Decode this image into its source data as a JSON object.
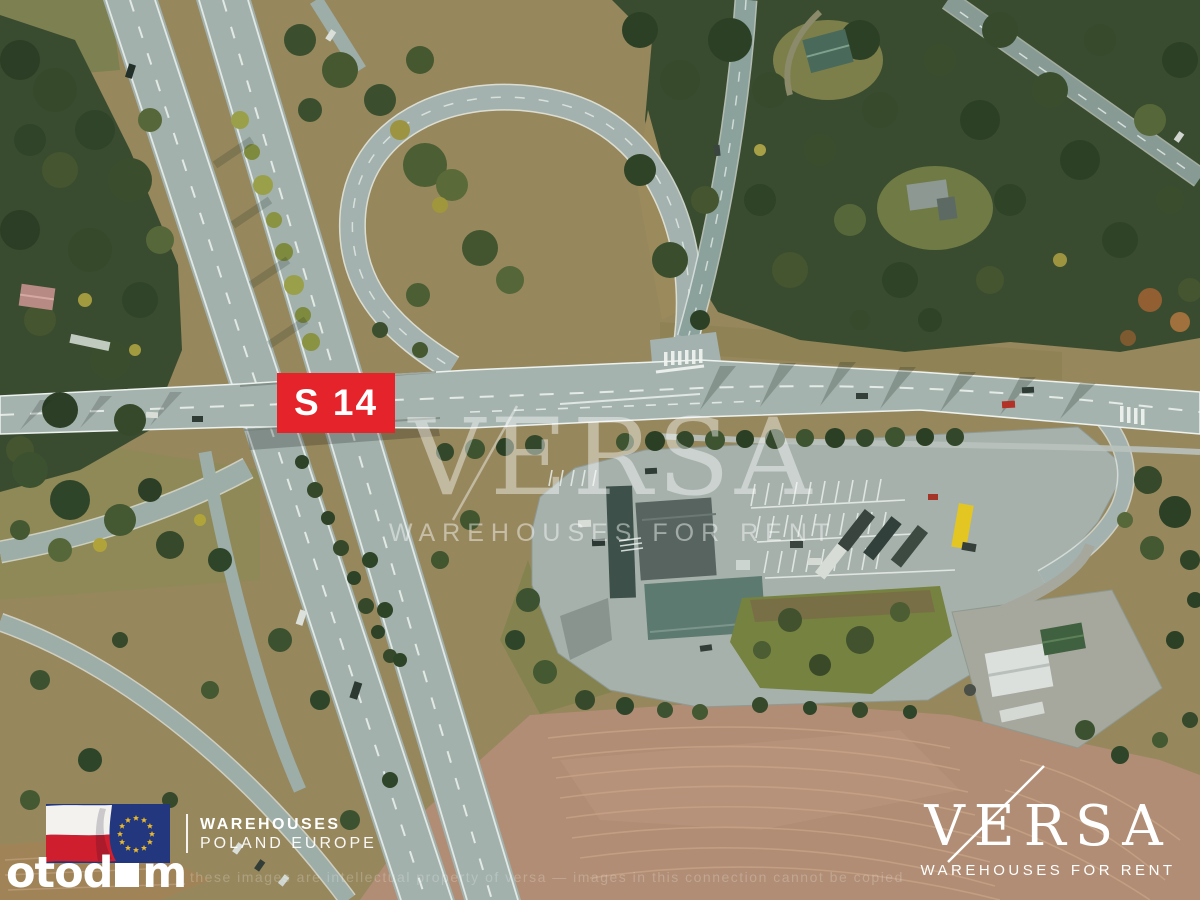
{
  "route_badge": {
    "label": "S 14",
    "bg_color": "#e5232a",
    "text_color": "#ffffff"
  },
  "center_watermark": {
    "brand": "VERSA",
    "tagline": "WAREHOUSES FOR RENT"
  },
  "banner": {
    "flag": "poland-eu-flag",
    "line1": "WAREHOUSES",
    "line2": "POLAND EUROPE"
  },
  "portal_logo": {
    "prefix": "otod",
    "suffix": "m"
  },
  "brand_logo": {
    "brand": "VERSA",
    "tagline": "WAREHOUSES FOR RENT"
  },
  "copyright_notice": "these images are intellectual property of versa — images in this connection cannot be copied"
}
